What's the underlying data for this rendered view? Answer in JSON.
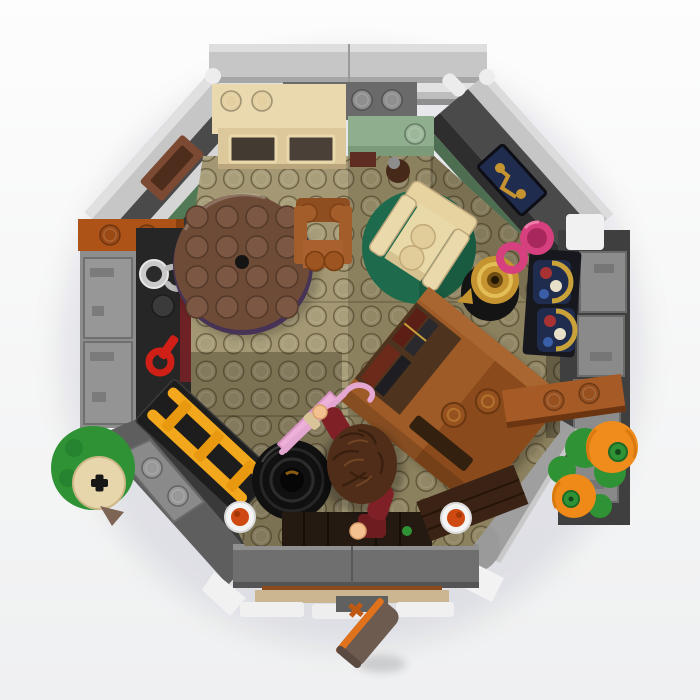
{
  "scene": {
    "description": "Top-down product photo of a LEGO octagonal hobbit-hole room interior with furniture, a minifigure and accessories, on a white studio background",
    "view": "top-down",
    "room_shape": "octagon",
    "stud_embossing": "LEGO"
  },
  "objects": [
    "gray-outer-walls",
    "kitchen-dresser",
    "mantel-plates",
    "sage-shelf",
    "brown-jug",
    "round-wooden-table",
    "wooden-chair",
    "tan-armchair",
    "green-round-rug",
    "writing-desk-with-books",
    "brown-plank",
    "ladder-on-chest",
    "black-cauldron",
    "hobbit-minifigure",
    "pink-umbrella",
    "silver-tankard",
    "red-key",
    "gold-lamp",
    "pink-jug",
    "stained-glass-windows",
    "candlestick-window",
    "breakfast-plates",
    "open-front-door",
    "door-step",
    "pumpkins",
    "garden-stump"
  ],
  "palette": {
    "bg_top": "#fdfdfd",
    "bg_bottom": "#f0f0f2",
    "wall_light": "#c6c6c6",
    "wall_silver": "#e2e2e2",
    "wall_mid": "#8d8d8d",
    "wall_dark": "#4a4a4a",
    "wall_black": "#262626",
    "brick_dark_orange": "#ad5318",
    "maroon_panel": "#6e2225",
    "floor_light": "#a39873",
    "floor_dark": "#8c815e",
    "table_brown": "#6e4b36",
    "chair_nougat": "#a35d2a",
    "armchair_tan": "#e9d9ab",
    "rug_green": "#1d6b4c",
    "dresser_cream": "#ead9ae",
    "shelf_sage": "#8fae8e",
    "desk_brown": "#9e5b27",
    "plank_brown": "#a65a25",
    "ladder_yellow": "#f2a71c",
    "barrel_black": "#101010",
    "hair_brown": "#4f2d18",
    "torso_dark_red": "#7e2026",
    "skin_light_nougat": "#f3c08f",
    "umbrella_pink": "#edb0d9",
    "jug_magenta": "#d6407e",
    "lamp_gold": "#c59330",
    "glass_navy": "#202c4e",
    "glass_gold": "#caa23a",
    "key_red": "#d01f17",
    "tankard_silver": "#c9c9c9",
    "pumpkin_orange": "#f08c1b",
    "leaf_green": "#2f9235",
    "plate_white": "#f4f4f4",
    "food_orange": "#cf4a12",
    "door_body": "#6e5b50",
    "door_edge_orange": "#e0721c",
    "step_tan": "#cbb691",
    "entry_dark": "#241a12"
  }
}
